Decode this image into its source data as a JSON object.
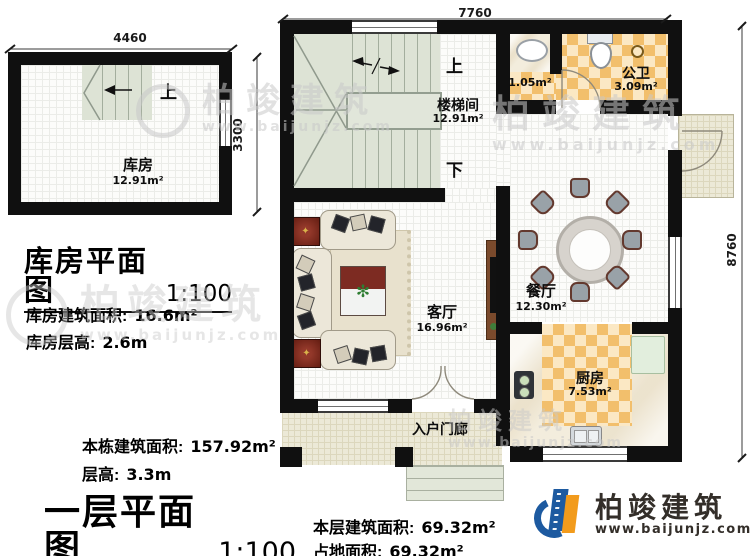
{
  "watermark": {
    "brand": "柏竣建筑",
    "url": "www.baijunjz.com"
  },
  "storage_plan": {
    "title": "库房平面图",
    "scale": "1:100",
    "dim_top": "4460",
    "dim_right": "3300",
    "up_label": "上",
    "room": {
      "name": "库房",
      "area": "12.91m²"
    },
    "stats": [
      {
        "label": "库房建筑面积:",
        "value": "16.6m²"
      },
      {
        "label": "库房层高:",
        "value": "2.6m"
      }
    ]
  },
  "main_plan": {
    "title": "一层平面图",
    "scale": "1:100",
    "dim_top": "7760",
    "dim_right": "8760",
    "up_label": "上",
    "down_label": "下",
    "rooms": {
      "stairwell": {
        "name": "楼梯间",
        "area": "12.91m²"
      },
      "wc_nook": {
        "area": "1.05m²"
      },
      "bathroom": {
        "name": "公卫",
        "area": "3.09m²"
      },
      "dining": {
        "name": "餐厅",
        "area": "12.30m²"
      },
      "living": {
        "name": "客厅",
        "area": "16.96m²"
      },
      "kitchen": {
        "name": "厨房",
        "area": "7.53m²"
      },
      "porch": {
        "name": "入户门廊"
      }
    },
    "building_stats": [
      {
        "label": "本栋建筑面积:",
        "value": "157.92m²"
      },
      {
        "label": "层高:",
        "value": "3.3m"
      }
    ],
    "floor_stats": [
      {
        "label": "本层建筑面积:",
        "value": "69.32m²"
      },
      {
        "label": "占地面积:",
        "value": "69.32m²"
      }
    ]
  },
  "logo": {
    "brand": "柏竣建筑",
    "url": "www.baijunjz.com"
  },
  "colors": {
    "wall": "#101010",
    "tile_orange": "#f2bf6c",
    "stair_green": "#dde3d5",
    "logo_blue": "#1d5aa0",
    "logo_orange": "#f29b1c"
  }
}
